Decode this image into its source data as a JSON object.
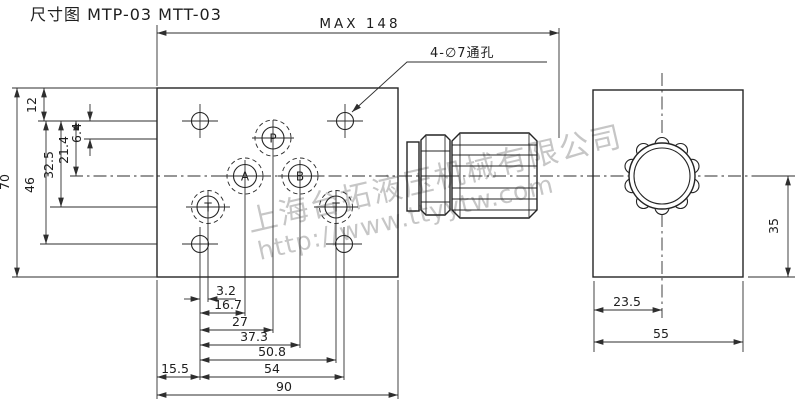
{
  "title": "尺寸图 MTP-03 MTT-03",
  "annotations": {
    "max_length": "MAX 148",
    "hole_callout": "4-∅7通孔"
  },
  "ports": {
    "p": "P",
    "a": "A",
    "b": "B",
    "t_left": "T",
    "t_right": "T"
  },
  "dims": {
    "left": {
      "d12": "12",
      "d6_4": "6.4",
      "d21_4": "21.4",
      "d32_5": "32.5",
      "d46": "46",
      "d70": "70"
    },
    "bottom": {
      "d3_2": "3.2",
      "d16_7": "16.7",
      "d27": "27",
      "d37_3": "37.3",
      "d50_8": "50.8",
      "d15_5": "15.5",
      "d54": "54",
      "d90": "90"
    },
    "side": {
      "d23_5": "23.5",
      "d55": "55",
      "d35": "35"
    }
  },
  "watermark": {
    "company": "上海台拓液压机械有限公司",
    "url": "http://www.ttyytw.com"
  },
  "colors": {
    "line": "#242424",
    "watermark": "#b9b9b9",
    "background": "#ffffff"
  }
}
